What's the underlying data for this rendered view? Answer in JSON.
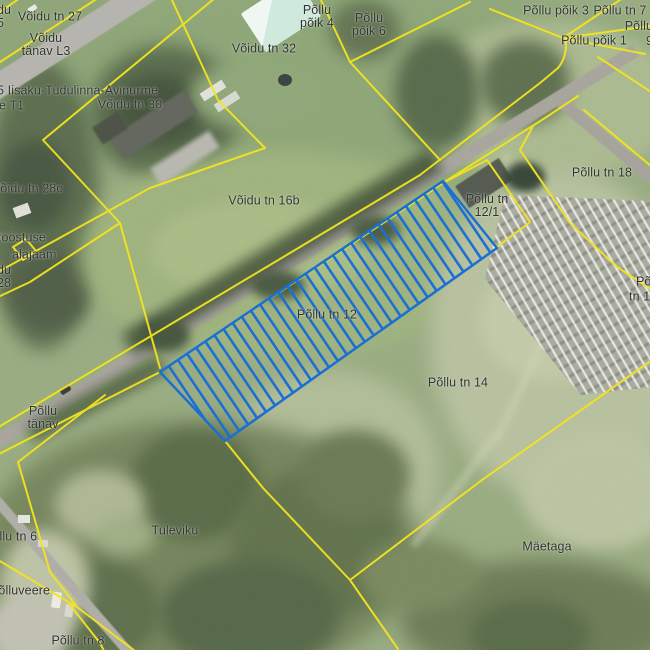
{
  "map": {
    "kind": "cadastral aerial map",
    "selected_parcel": "Põllu tn 12",
    "colors": {
      "boundary": "#f3e41e",
      "selection": "#1a6fd4",
      "label_text": "#2e332e"
    }
  },
  "labels": {
    "voidu_tn_27": {
      "text": "Võidu tn 27"
    },
    "frag_25": {
      "lines": [
        "du",
        "5"
      ]
    },
    "voidu_tanav_l3": {
      "lines": [
        "Võidu",
        "tänav L3"
      ]
    },
    "road_85": {
      "text": "85 Iisaku-Tudulinna-Avinurme"
    },
    "frag_tee_t1": {
      "text": "ee T1"
    },
    "voidu_tn_30": {
      "text": "Võidu tn 30"
    },
    "voidu_tn_32": {
      "text": "Võidu tn 32"
    },
    "pollu_poik_4": {
      "lines": [
        "Põllu",
        "põik 4"
      ]
    },
    "pollu_poik_6": {
      "lines": [
        "Põllu",
        "põik 6"
      ]
    },
    "pollu_poik_3": {
      "text": "Põllu põik 3"
    },
    "pollu_tn_7": {
      "text": "Põllu tn 7"
    },
    "frag_pollu_9": {
      "lines": [
        "Põllu",
        "9"
      ]
    },
    "pollu_poik_1": {
      "text": "Põllu põik 1"
    },
    "voidu_tn_28c": {
      "text": "Võidu tn 28c"
    },
    "frag_itoostuse": {
      "text": "itööstuse"
    },
    "frag_alajaam": {
      "text": "alajaam"
    },
    "frag_du_28": {
      "lines": [
        "du",
        "28"
      ]
    },
    "voidu_tn_16b": {
      "text": "Võidu tn 16b"
    },
    "pollu_tn_18": {
      "text": "Põllu tn 18"
    },
    "pollu_tn_12_1": {
      "lines": [
        "Põllu tn",
        "12/1"
      ]
    },
    "pollu_tn_12": {
      "text": "Põllu tn 12"
    },
    "pollu_tn_14": {
      "text": "Põllu tn 14"
    },
    "frag_po": {
      "text": "Põ"
    },
    "frag_tn_1": {
      "text": "tn 1"
    },
    "pollu_tanav": {
      "lines": [
        "Põllu",
        "tänav"
      ]
    },
    "pollu_tn_6": {
      "text": "Põllu tn 6"
    },
    "polluveere": {
      "text": "Põlluveere"
    },
    "pollu_tn_8": {
      "text": "Põllu tn 8"
    },
    "tuleviku": {
      "text": "Tuleviku"
    },
    "maetaga": {
      "text": "Mäetaga"
    }
  }
}
